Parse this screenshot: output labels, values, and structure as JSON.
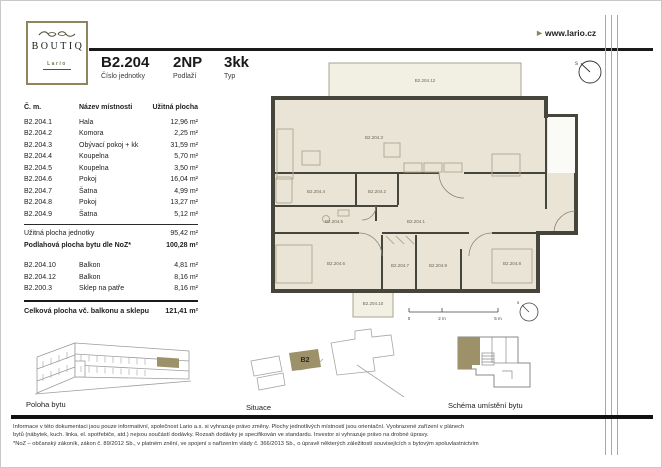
{
  "brand": {
    "name": "BOUTIQ",
    "subname": "Lario",
    "website": "www.lario.cz",
    "website_arrow": "▶"
  },
  "header": {
    "unit_number": "B2.204",
    "unit_number_label": "Číslo jednotky",
    "floor": "2NP",
    "floor_label": "Podlaží",
    "type": "3kk",
    "type_label": "Typ"
  },
  "rooms_table": {
    "headers": [
      "Č. m.",
      "Název místnosti",
      "Užitná plocha"
    ],
    "rows": [
      {
        "code": "B2.204.1",
        "name": "Hala",
        "area": "12,96 m²"
      },
      {
        "code": "B2.204.2",
        "name": "Komora",
        "area": "2,25 m²"
      },
      {
        "code": "B2.204.3",
        "name": "Obývací pokoj + kk",
        "area": "31,59 m²"
      },
      {
        "code": "B2.204.4",
        "name": "Koupelna",
        "area": "5,70 m²"
      },
      {
        "code": "B2.204.5",
        "name": "Koupelna",
        "area": "3,50 m²"
      },
      {
        "code": "B2.204.6",
        "name": "Pokoj",
        "area": "16,04 m²"
      },
      {
        "code": "B2.204.7",
        "name": "Šatna",
        "area": "4,99 m²"
      },
      {
        "code": "B2.204.8",
        "name": "Pokoj",
        "area": "13,27 m²"
      },
      {
        "code": "B2.204.9",
        "name": "Šatna",
        "area": "5,12 m²"
      }
    ],
    "summary": [
      {
        "label": "Užitná plocha jednotky",
        "value": "95,42 m²"
      },
      {
        "label": "Podlahová plocha bytu dle NoZ*",
        "value": "100,28 m²"
      }
    ],
    "extras": [
      {
        "code": "B2.204.10",
        "name": "Balkon",
        "area": "4,81 m²"
      },
      {
        "code": "B2.204.12",
        "name": "Balkon",
        "area": "8,16 m²"
      },
      {
        "code": "B2.200.3",
        "name": "Sklep na patře",
        "area": "8,16 m²"
      }
    ],
    "total": {
      "label": "Celková plocha vč. balkonu a sklepu",
      "value": "121,41 m²"
    }
  },
  "floor_plan": {
    "labels": {
      "balcony_top": "B2.204.12",
      "living": "B2.204.3",
      "bathroom1": "B2.204.4",
      "komora": "B2.204.2",
      "bathroom2": "B2.204.5",
      "hala": "B2.204.1",
      "room1": "B2.204.6",
      "wardrobe1": "B2.204.7",
      "wardrobe2": "B2.204.9",
      "room2": "B2.204.8",
      "balcony_bottom": "B2.204.10"
    },
    "scale": {
      "zero": "0",
      "two": "2 m",
      "five": "5 m"
    },
    "compass": "s"
  },
  "figures": {
    "poloha_label": "Poloha bytu",
    "situace_label": "Situace",
    "situace_highlight": "B2",
    "schema_label": "Schéma umístění bytu"
  },
  "footer": {
    "lines": [
      "Informace v této dokumentaci jsou pouze informativní, společnost Lario a.s. si vyhrazuje právo změny. Plochy jednotlivých místností jsou orientační. Vyobrazené zařízení v plánech",
      "bytů (nábytek, kuch. linka, el. spotřebiče, atd.) nejsou součástí dodávky. Rozsah dodávky je specifikován ve standardu. Investor si vyhrazuje právo na drobné úpravy.",
      "*NoZ – občanský zákoník, zákon č. 89/2012 Sb., v platném znění, ve spojení s nařízením vlády č. 366/2013 Sb., o úpravě některých záležitostí souvisejících s bytovým spoluvlastnictvím"
    ]
  },
  "colors": {
    "accent_gold": "#9c9168",
    "gold_line": "#b6ab80",
    "wall": "#45453c",
    "room_fill": "#e9e4d6",
    "balcony_fill": "#f2efe3",
    "rule_black": "#1a1a1a"
  }
}
